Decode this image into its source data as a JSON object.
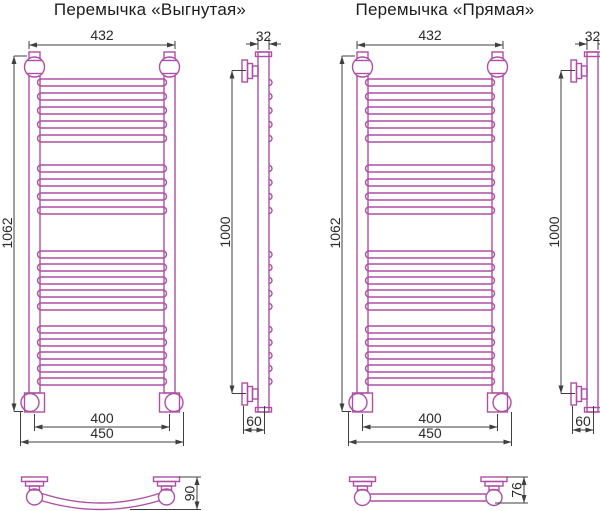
{
  "colors": {
    "drawing": "#ad4fa4",
    "dimension": "#3f3f3f",
    "text": "#2a2a2a",
    "background": "#ffffff"
  },
  "views": {
    "curved": {
      "title": "Перемычка «Выгнутая»",
      "front": {
        "width": "432",
        "height": "1062",
        "inner_width": "400",
        "outer_width": "450",
        "rung_groups": [
          5,
          4,
          5,
          5
        ]
      },
      "side": {
        "width": "32",
        "height": "1000",
        "depth": "60",
        "has_bumps": true
      },
      "crossbar_detail": {
        "depth": "90",
        "shape": "curved"
      }
    },
    "straight": {
      "title": "Перемычка «Прямая»",
      "front": {
        "width": "432",
        "height": "1062",
        "inner_width": "400",
        "outer_width": "450",
        "rung_groups": [
          5,
          4,
          5,
          5
        ]
      },
      "side": {
        "width": "32",
        "height": "1000",
        "depth": "60",
        "has_bumps": false
      },
      "crossbar_detail": {
        "depth": "76",
        "shape": "straight"
      }
    }
  }
}
